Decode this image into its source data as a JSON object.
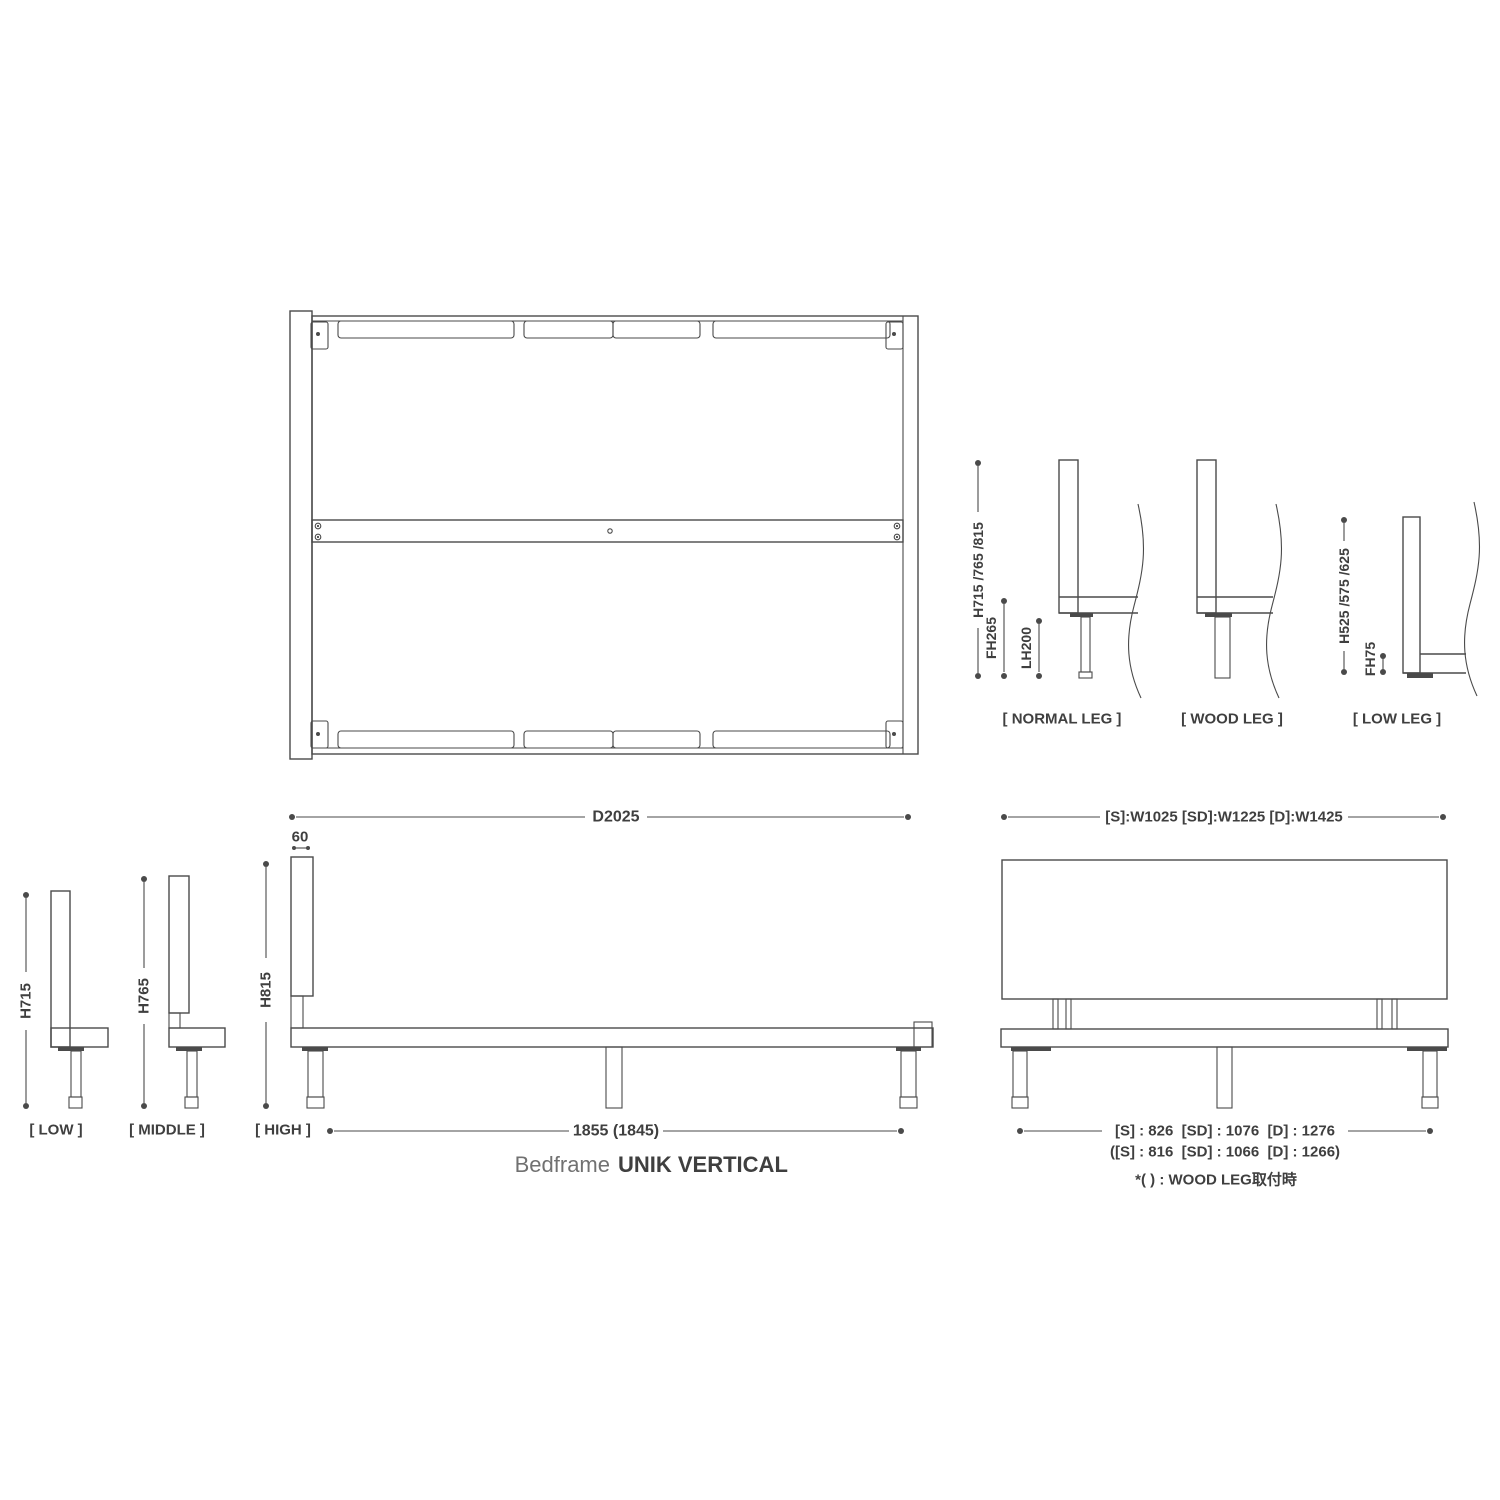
{
  "title": {
    "prefix": "Bedframe",
    "name": "UNIK VERTICAL"
  },
  "legs": {
    "h_dim": "H715 /765 /815",
    "fh265": "FH265",
    "lh200": "LH200",
    "h_low_dim": "H525 /575 /625",
    "fh75": "FH75",
    "normal_label": "[ NORMAL LEG ]",
    "wood_label": "[ WOOD LEG ]",
    "low_label": "[ LOW LEG ]"
  },
  "side": {
    "d2025": "D2025",
    "t60": "60",
    "span": "1855 (1845)",
    "h715": "H715",
    "h765": "H765",
    "h815": "H815",
    "low_label": "[ LOW ]",
    "middle_label": "[ MIDDLE ]",
    "high_label": "[ HIGH ]"
  },
  "front": {
    "width_dim": "[S]:W1025 [SD]:W1225 [D]:W1425",
    "span_dim": "[S] : 826  [SD] : 1076  [D] : 1276",
    "span_dim_wood": "([S] : 816  [SD] : 1066  [D] : 1266)",
    "note": "*( ) : WOOD LEG取付時"
  },
  "colors": {
    "line": "#4a4a4a",
    "text": "#3f3f3f",
    "muted": "#717171"
  }
}
